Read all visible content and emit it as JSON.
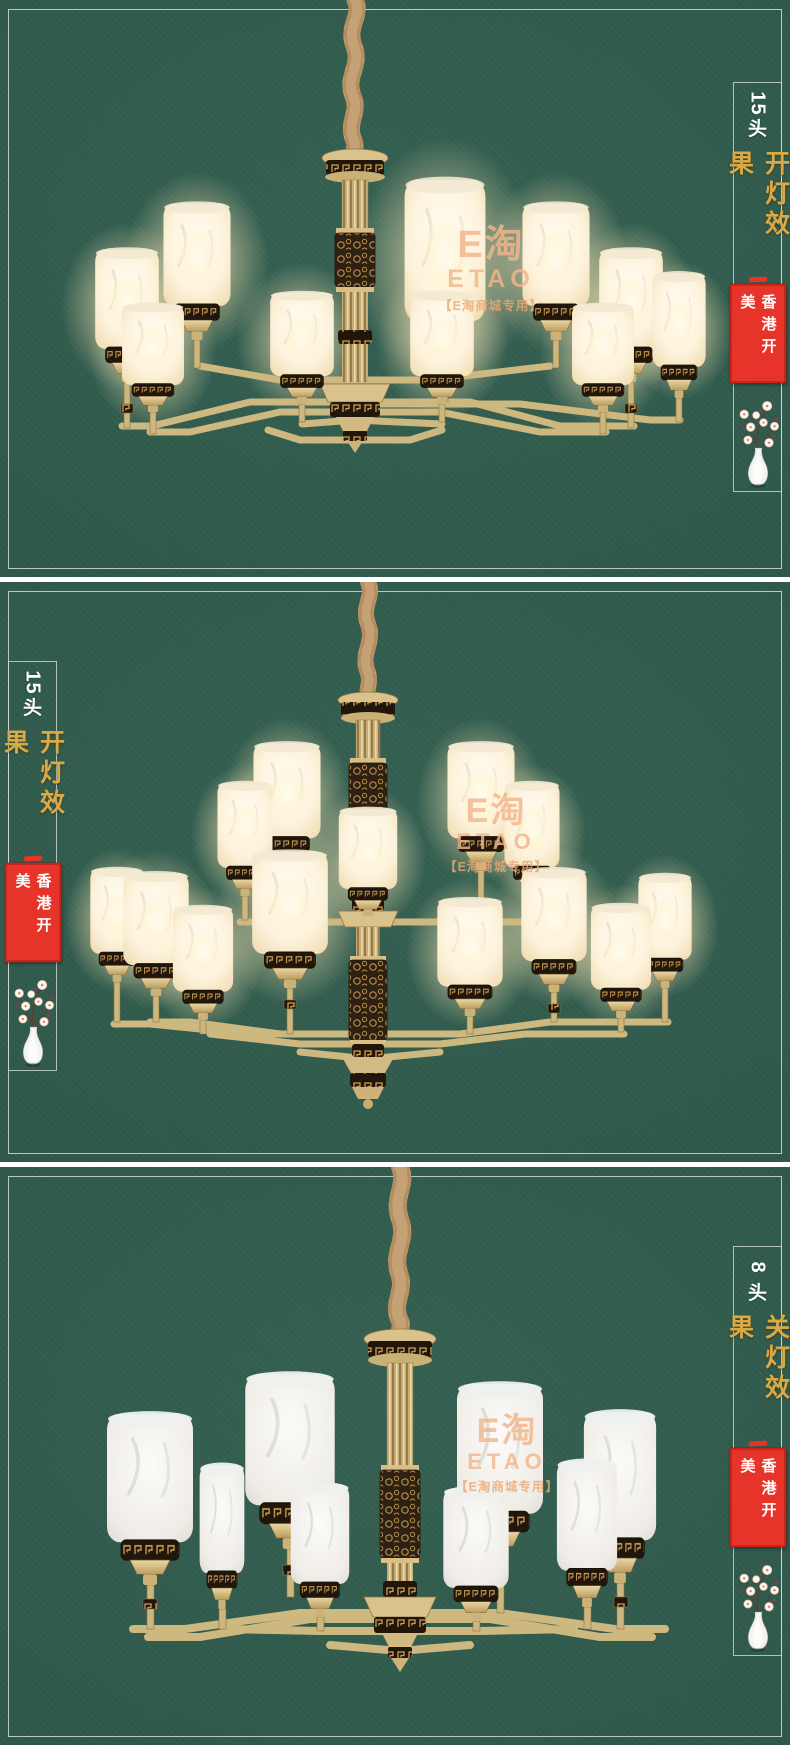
{
  "watermark": {
    "logo_cn": "E淘",
    "logo_en": "ETAO",
    "caption": "【E淘商城专用】"
  },
  "panels": [
    {
      "head_count": "15",
      "head_unit": "头",
      "effect_label": "开灯效果",
      "brand_seal": "香港开美",
      "lights": "on",
      "annotation_side": "right"
    },
    {
      "head_count": "15",
      "head_unit": "头",
      "effect_label": "开灯效果",
      "brand_seal": "香港开美",
      "lights": "on",
      "annotation_side": "left"
    },
    {
      "head_count": "8",
      "head_unit": "头",
      "effect_label": "关灯效果",
      "brand_seal": "香港开美",
      "lights": "off",
      "annotation_side": "right"
    }
  ],
  "colors": {
    "panel_green": "#2F594B",
    "frame_line": "#CFD9D2",
    "gold_text": "#D9A945",
    "seal_red": "#E7342B",
    "seal_text": "#FFFFFF",
    "head_text": "#FFFFFF",
    "watermark_tan": "#F2B68C",
    "brass": "#D3BC85",
    "rope_tan": "#D8AC7E"
  }
}
